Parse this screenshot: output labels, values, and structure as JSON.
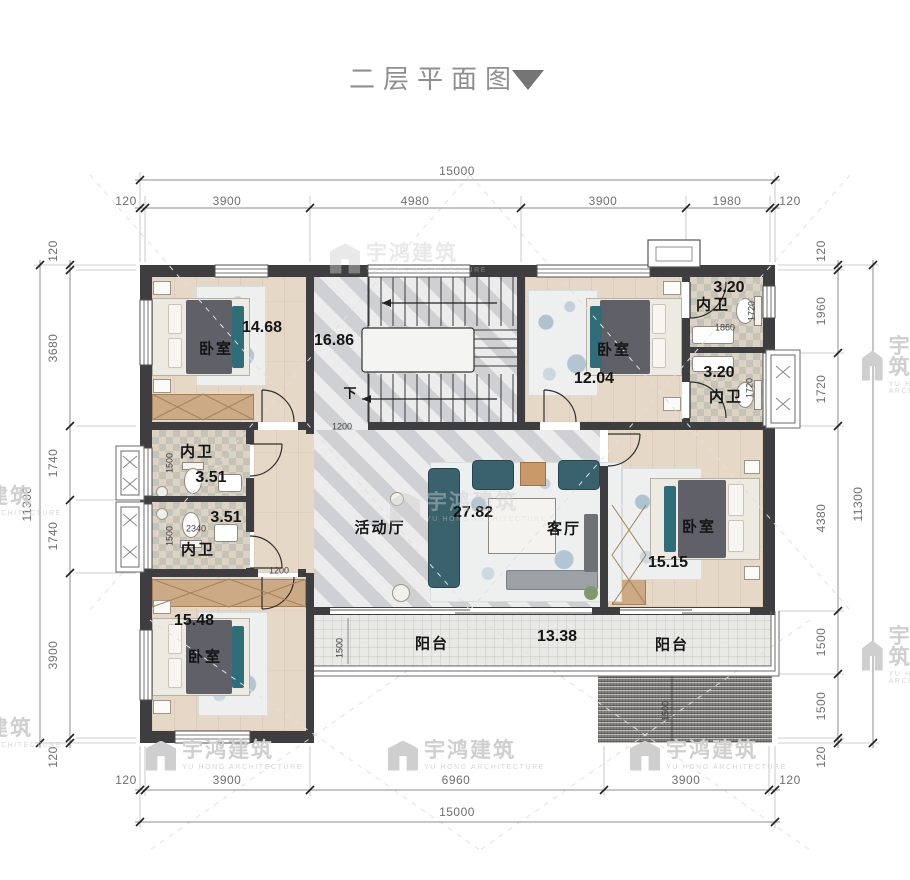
{
  "title": {
    "text": "二层平面图",
    "icon": "triangle-down"
  },
  "watermark": {
    "cn": "宇鸿建筑",
    "en": "YU HONG ARCHITECTURE"
  },
  "colors": {
    "wall": "#3e3e40",
    "accent_teal": "#2f6e79",
    "watermark": "#cfcfcf",
    "dim_text": "#6f6f6f"
  },
  "dims": {
    "top": {
      "total": "15000",
      "segments": [
        "120",
        "3900",
        "4980",
        "3900",
        "1980",
        "120"
      ]
    },
    "bottom": {
      "total": "15000",
      "segments": [
        "120",
        "3900",
        "6960",
        "3900",
        "120"
      ]
    },
    "left": {
      "total": "11300",
      "segments": [
        "120",
        "3680",
        "1740",
        "1740",
        "3900",
        "120"
      ]
    },
    "right": {
      "total": "11300",
      "segments": [
        "120",
        "1960",
        "1720",
        "4380",
        "1500",
        "1500",
        "120"
      ]
    }
  },
  "rooms": {
    "bedroom_tl": {
      "name": "卧室",
      "area": "14.68"
    },
    "stair_hall": {
      "area": "16.86",
      "down_label": "下",
      "dim_width": "1200"
    },
    "bedroom_tr": {
      "name": "卧室",
      "area": "12.04"
    },
    "bath_tr_top": {
      "name": "内卫",
      "area": "3.20",
      "dim_width": "1860",
      "dim_height": "1720"
    },
    "bath_tr_bottom": {
      "name": "内卫",
      "area": "3.20",
      "dim_height": "1720"
    },
    "bath_left_top": {
      "name": "内卫",
      "area": "3.51",
      "dim_height": "1500"
    },
    "bath_left_bottom": {
      "name": "内卫",
      "area": "3.51",
      "dim_width": "2340",
      "dim_height": "1500",
      "door_dim": "1200"
    },
    "activity_hall": {
      "name": "活动厅",
      "area": "27.82"
    },
    "living_room": {
      "name": "客厅"
    },
    "bedroom_right": {
      "name": "卧室",
      "area": "15.15"
    },
    "bedroom_bl": {
      "name": "卧室",
      "area": "15.48"
    },
    "balcony": {
      "name_left": "阳台",
      "area": "13.38",
      "name_right": "阳台",
      "dim_depth": "1500"
    },
    "roof_below": {
      "dim_depth": "1500"
    }
  }
}
